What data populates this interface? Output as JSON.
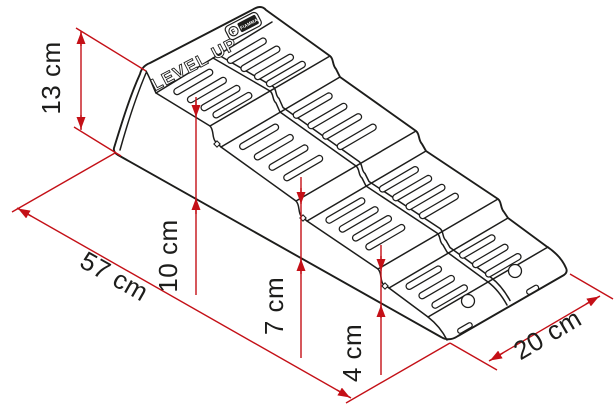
{
  "product": {
    "name": "LEVEL UP",
    "brand": "FIAMMA",
    "brand_initial": "F"
  },
  "dimensions": {
    "total_height": "13 cm",
    "base_length": "57 cm",
    "level_3": "10 cm",
    "level_2": "7 cm",
    "level_1": "4 cm",
    "width": "20 cm"
  },
  "colors": {
    "dimension_red": "#c41017",
    "linework": "#1d1d1b",
    "background": "#ffffff"
  }
}
